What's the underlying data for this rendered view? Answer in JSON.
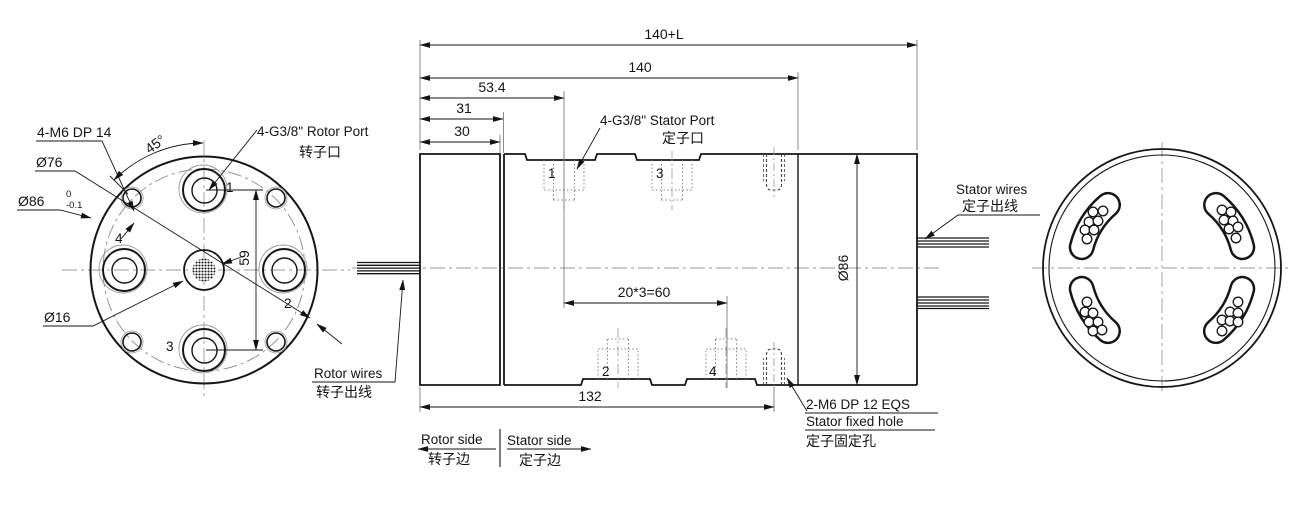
{
  "front_view": {
    "m6_callout": "4-M6 DP 14",
    "bolt_circle_dia": "Ø76",
    "outer_dia": "Ø86",
    "outer_dia_tol_upper": "0",
    "outer_dia_tol_lower": "-0.1",
    "center_hole_dia": "Ø16",
    "angle": "45°",
    "port_pitch": "59",
    "rotor_port": "4-G3/8\" Rotor Port",
    "rotor_port_cn": "转子口",
    "rotor_wires": "Rotor wires",
    "rotor_wires_cn": "转子出线",
    "ports": [
      "1",
      "2",
      "3",
      "4"
    ]
  },
  "side_view": {
    "dim_total": "140+L",
    "dim_body": "140",
    "dim_port1": "53.4",
    "dim_rotor2": "31",
    "dim_rotor1": "30",
    "dim_port_span": "20*3=60",
    "dim_stator": "132",
    "dim_dia": "Ø86",
    "stator_port": "4-G3/8\" Stator Port",
    "stator_port_cn": "定子口",
    "stator_wires": "Stator wires",
    "stator_wires_cn": "定子出线",
    "fixed_hole_spec": "2-M6 DP 12 EQS",
    "fixed_hole": "Stator fixed hole",
    "fixed_hole_cn": "定子固定孔",
    "rotor_side": "Rotor side",
    "rotor_side_cn": "转子边",
    "stator_side": "Stator side",
    "stator_side_cn": "定子边",
    "ports": [
      "1",
      "2",
      "3",
      "4"
    ]
  }
}
